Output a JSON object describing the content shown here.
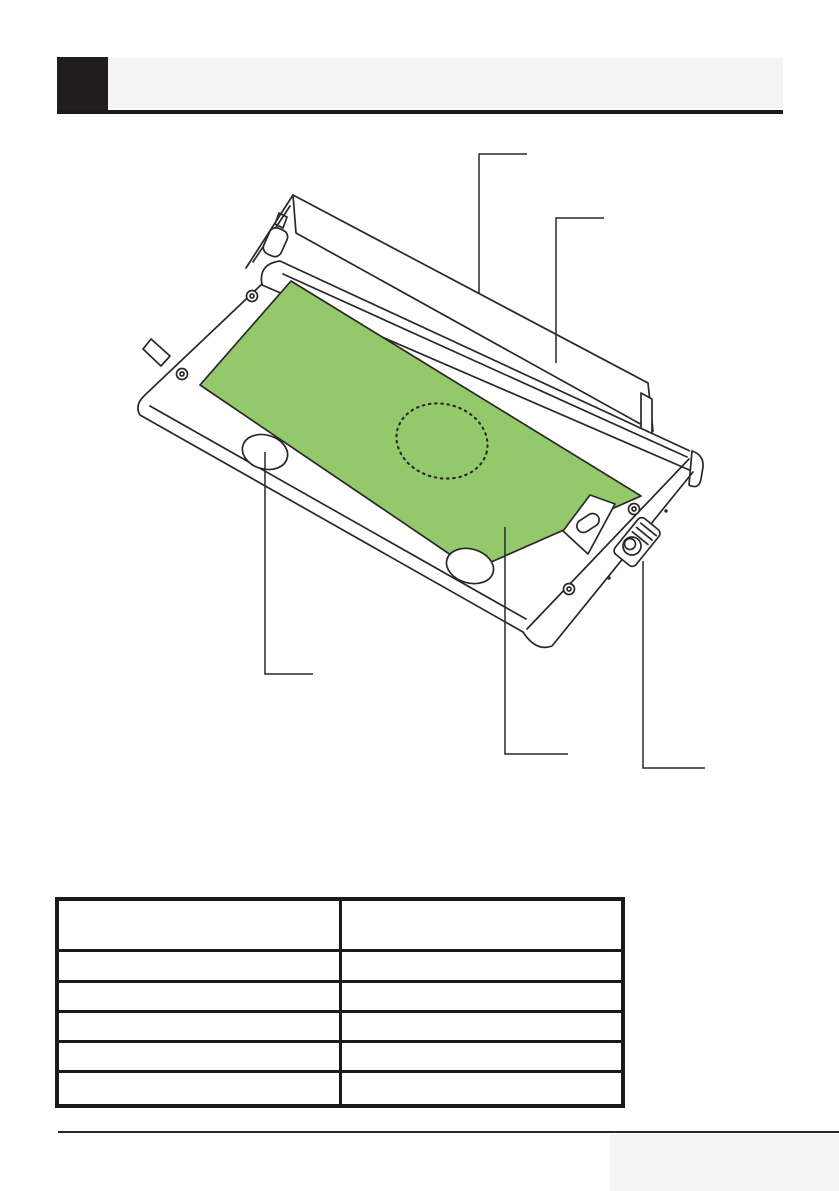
{
  "page": {
    "kind": "appliance-manual-page",
    "width": 839,
    "height": 1191
  },
  "colors": {
    "paper": "#ffffff",
    "chapter_box": "#221e1f",
    "header_band": "#f4f4f4",
    "rule": "#1d191a",
    "line": "#2b2728",
    "filter_green": "#93c96a",
    "corner_box": "#f5f5f5",
    "table_border": "#1d191a"
  },
  "illustration": {
    "subject": "telescopic-cooker-hood-underside",
    "callouts": [
      {
        "target": "air-outlet-top",
        "points": "527,154 479,154 479,293"
      },
      {
        "target": "rear-panel",
        "points": "604,218 556,218 556,363"
      },
      {
        "target": "lamp",
        "points": "265,452 265,674 313,674"
      },
      {
        "target": "grease-filter",
        "points": "505,527 505,754 568,754"
      },
      {
        "target": "slide-switch",
        "points": "643,561 643,768 705,768"
      }
    ]
  },
  "table": {
    "columns": [
      "",
      ""
    ],
    "rows": [
      [
        "",
        ""
      ],
      [
        "",
        ""
      ],
      [
        "",
        ""
      ],
      [
        "",
        ""
      ],
      [
        "",
        ""
      ],
      [
        "",
        ""
      ]
    ]
  }
}
